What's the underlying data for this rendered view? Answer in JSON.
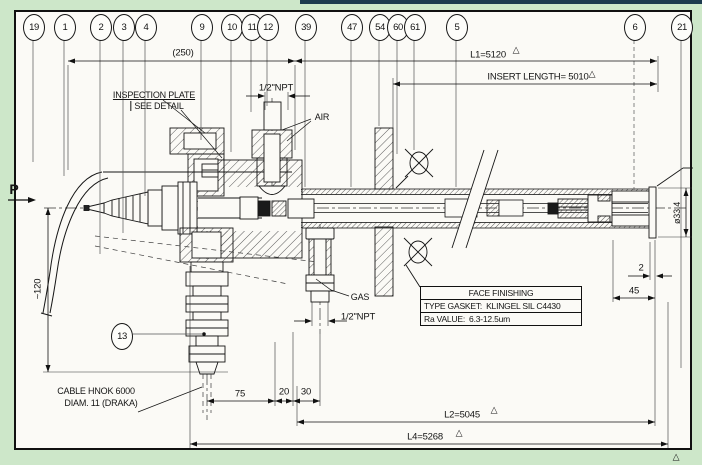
{
  "drawing": {
    "balloons": [
      {
        "n": "19"
      },
      {
        "n": "1"
      },
      {
        "n": "2"
      },
      {
        "n": "3"
      },
      {
        "n": "4"
      },
      {
        "n": "9"
      },
      {
        "n": "10"
      },
      {
        "n": "11"
      },
      {
        "n": "12"
      },
      {
        "n": "39"
      },
      {
        "n": "47"
      },
      {
        "n": "54"
      },
      {
        "n": "60"
      },
      {
        "n": "61"
      },
      {
        "n": "5"
      },
      {
        "n": "6"
      },
      {
        "n": "21"
      },
      {
        "n": "13"
      }
    ],
    "labels": {
      "flow": "P",
      "air": "AIR",
      "gas": "GAS",
      "npt_top": "1/2\"NPT",
      "npt_bottom": "1/2\"NPT",
      "inspection_plate": "INSPECTION PLATE",
      "see_detail": "SEE DETAIL",
      "cable_line1": "CABLE HNOK 6000",
      "cable_line2": "DIAM. 11 (DRAKA)"
    },
    "dimensions": {
      "overall_250": "(250)",
      "l1": "L1=5120",
      "insert_length": "INSERT LENGTH= 5010",
      "approx_120": "~120",
      "d75": "75",
      "d20": "20",
      "d30": "30",
      "d2": "2",
      "d45": "45",
      "l2": "L2=5045",
      "l4": "L4=5268",
      "diameter": "ø33.4"
    },
    "table": {
      "title": "FACE FINISHING",
      "rows": [
        {
          "label": "TYPE GASKET:",
          "value": "KLINGEL SIL C4430"
        },
        {
          "label": "Ra VALUE:",
          "value": "6.3-12.5um"
        }
      ]
    },
    "icons": {
      "revision_triangle": "△"
    }
  }
}
